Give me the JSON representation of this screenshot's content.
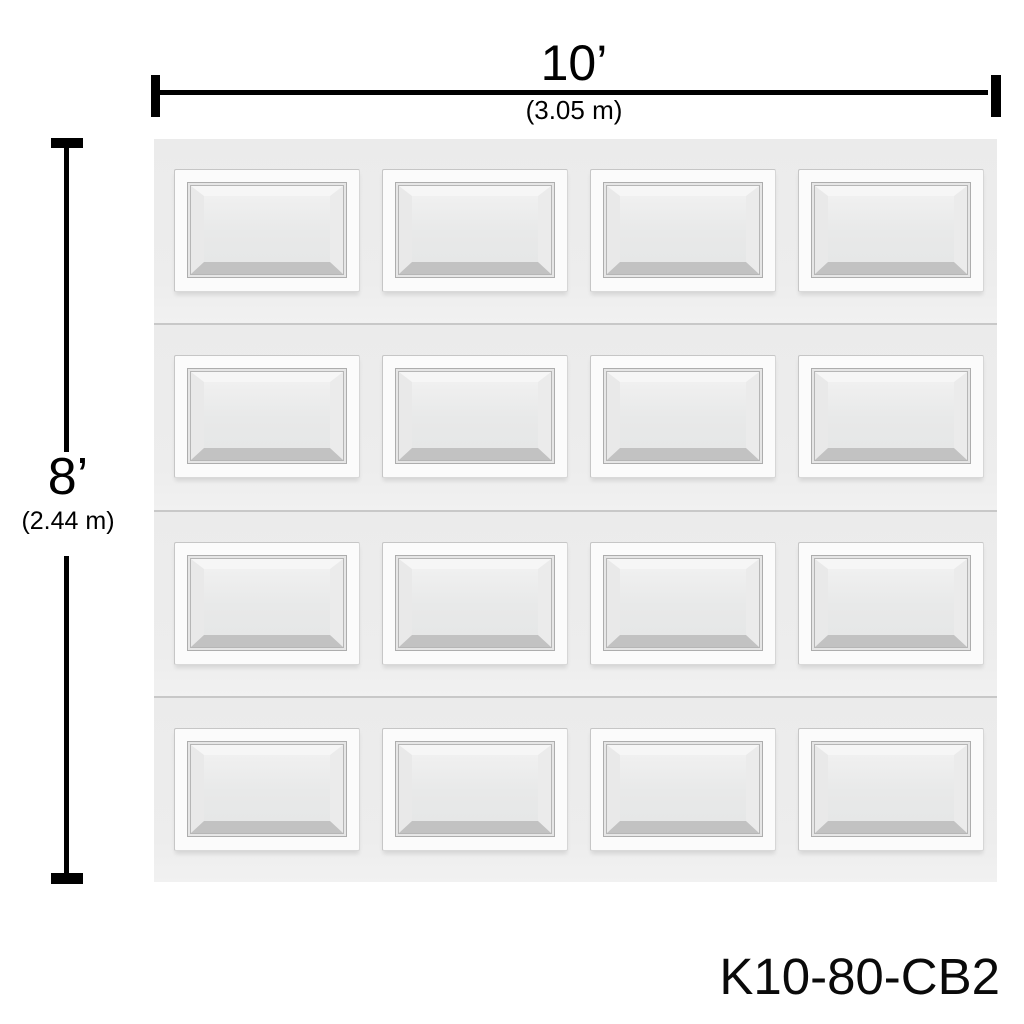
{
  "dimensions": {
    "width": {
      "label": "10’",
      "metric": "(3.05 m)"
    },
    "height": {
      "label": "8’",
      "metric": "(2.44 m)"
    }
  },
  "product_code": "K10-80-CB2",
  "door": {
    "rows": 4,
    "columns": 4,
    "panel_style": "raised-short-panel",
    "colors": {
      "canvas": "#ffffff",
      "dimension_ink": "#000000",
      "door_face": "#ededed",
      "panel_frame": "#fbfbfb",
      "panel_field": "#e8e9e9",
      "molding_line": "#b6b6b6",
      "section_separator": "#c8c8c8"
    }
  }
}
